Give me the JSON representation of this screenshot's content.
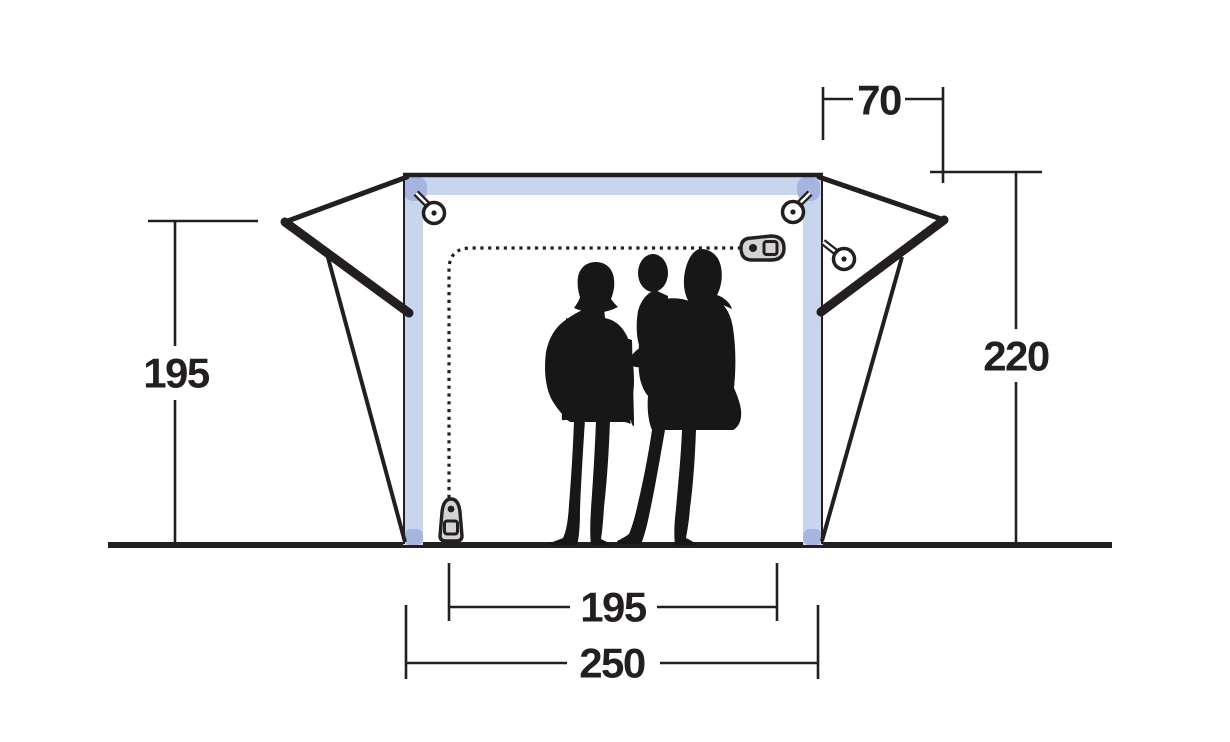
{
  "diagram": {
    "title": "tent-front-elevation-dimension-diagram",
    "dimensions": {
      "wing_depth": "70",
      "total_height": "220",
      "side_height": "195",
      "inner_width": "195",
      "outer_width": "250"
    },
    "colors": {
      "line": "#231f20",
      "frame": "#c9d4ee",
      "frame_corner": "#a6b5e0",
      "hardware": "#d3d3d3",
      "figures": "#171717",
      "background": "#ffffff"
    },
    "icons": {
      "guy_rope_ring": "guy-rope-ring-icon",
      "zipper_pull": "zipper-pull-icon",
      "family": "family-silhouette"
    }
  }
}
